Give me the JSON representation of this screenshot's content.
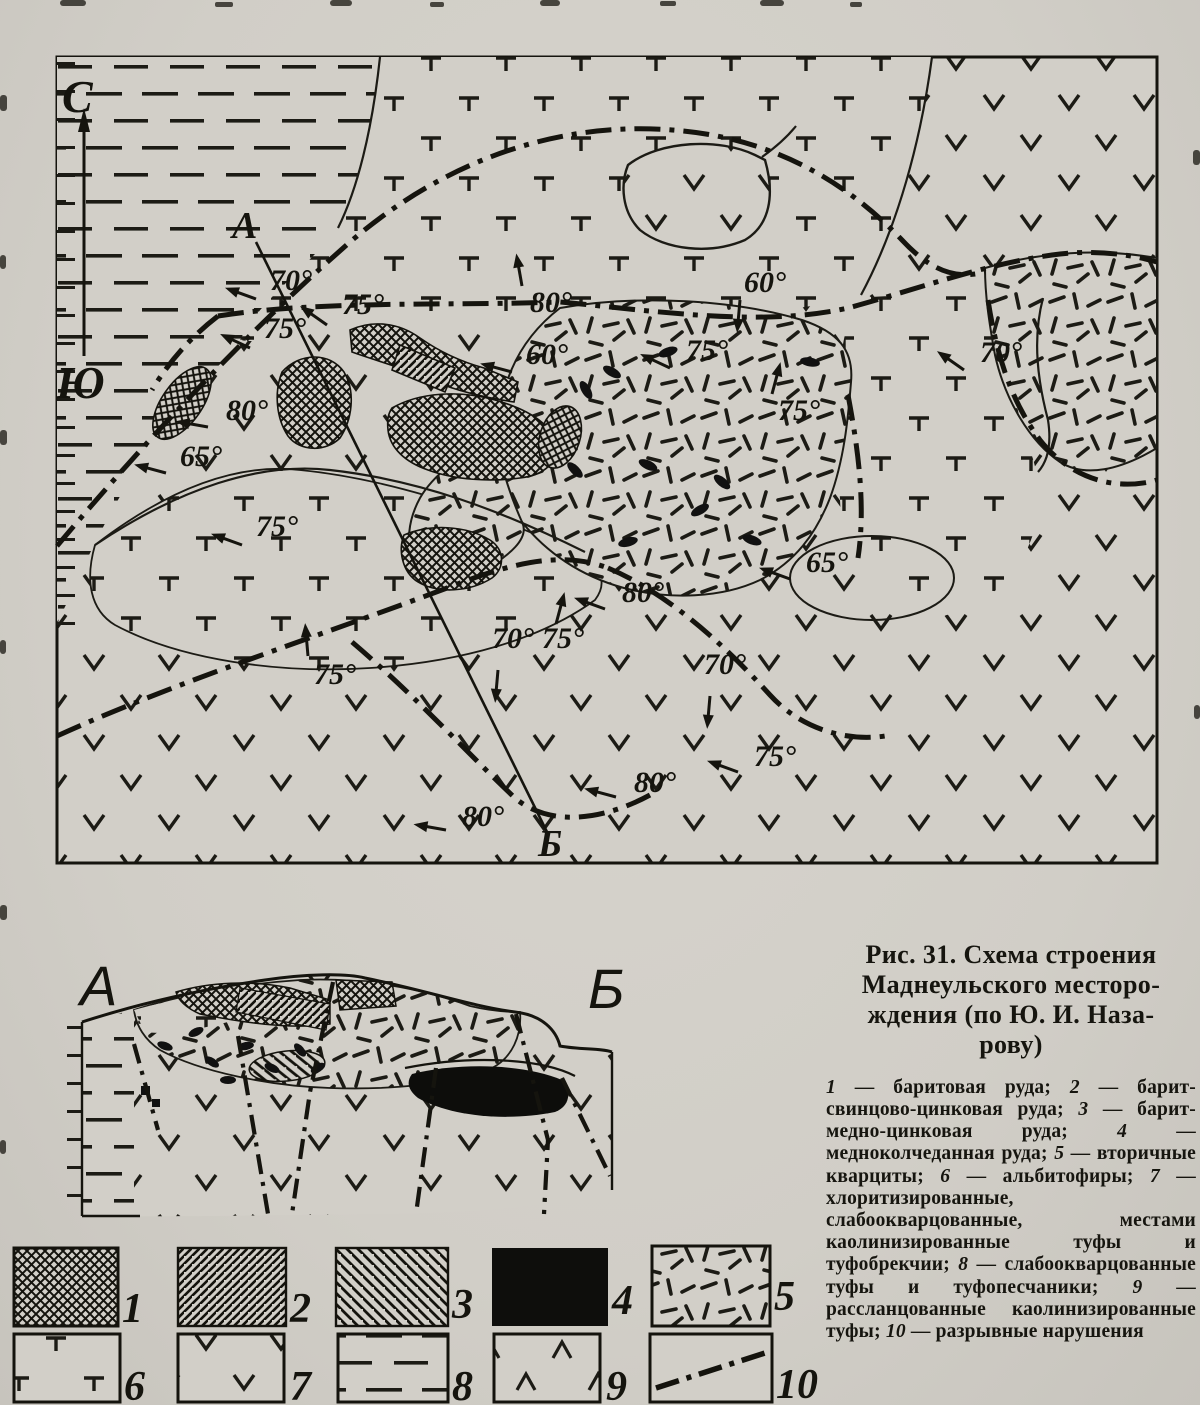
{
  "caption": {
    "title": "Рис. 31. Схема строения\nМаднеульского месторо-\nждения (по Ю. И. Наза-\nрову)",
    "legend_items": [
      {
        "num": "1",
        "label": "баритовая руда"
      },
      {
        "num": "2",
        "label": "барит-свинцово-цинковая руда"
      },
      {
        "num": "3",
        "label": "барит-медно-цинковая руда"
      },
      {
        "num": "4",
        "label": "медноколчеданная руда"
      },
      {
        "num": "5",
        "label": "вторичные кварциты"
      },
      {
        "num": "6",
        "label": "альбитофиры"
      },
      {
        "num": "7",
        "label": "хлоритизированные, слабоокварцованные, местами каолинизированные туфы и туфобрекчии"
      },
      {
        "num": "8",
        "label": "слабоокварцованные туфы и туфопесчаники"
      },
      {
        "num": "9",
        "label": "рассланцованные каолинизированные туфы"
      },
      {
        "num": "10",
        "label": "разрывные нарушения"
      }
    ]
  },
  "map": {
    "compass": {
      "north": "С",
      "south": "Ю"
    },
    "section_labels": {
      "start": "А",
      "end": "Б"
    },
    "dip_labels": [
      {
        "t": "70°",
        "x": 270,
        "y": 290,
        "ax": 256,
        "ay": 299,
        "a": 200
      },
      {
        "t": "75°",
        "x": 264,
        "y": 338,
        "ax": 250,
        "ay": 348,
        "a": 205
      },
      {
        "t": "75°",
        "x": 342,
        "y": 314,
        "ax": 327,
        "ay": 325,
        "a": 215
      },
      {
        "t": "80°",
        "x": 530,
        "y": 312,
        "ax": 522,
        "ay": 286,
        "a": 260
      },
      {
        "t": "60°",
        "x": 526,
        "y": 364,
        "ax": 512,
        "ay": 372,
        "a": 195
      },
      {
        "t": "60°",
        "x": 744,
        "y": 292,
        "ax": 740,
        "ay": 300,
        "a": 95
      },
      {
        "t": "75°",
        "x": 686,
        "y": 360,
        "ax": 670,
        "ay": 368,
        "a": 205
      },
      {
        "t": "70°",
        "x": 980,
        "y": 362,
        "ax": 964,
        "ay": 370,
        "a": 215
      },
      {
        "t": "80°",
        "x": 226,
        "y": 420,
        "ax": 208,
        "ay": 427,
        "a": 190
      },
      {
        "t": "65°",
        "x": 180,
        "y": 466,
        "ax": 166,
        "ay": 473,
        "a": 195
      },
      {
        "t": "75°",
        "x": 256,
        "y": 536,
        "ax": 242,
        "ay": 545,
        "a": 200
      },
      {
        "t": "75°",
        "x": 778,
        "y": 420,
        "ax": 772,
        "ay": 394,
        "a": 285
      },
      {
        "t": "65°",
        "x": 806,
        "y": 572,
        "ax": 790,
        "ay": 579,
        "a": 200
      },
      {
        "t": "80°",
        "x": 622,
        "y": 602,
        "ax": 605,
        "ay": 609,
        "a": 200
      },
      {
        "t": "75°",
        "x": 314,
        "y": 684,
        "ax": 308,
        "ay": 656,
        "a": 265
      },
      {
        "t": "70°",
        "x": 492,
        "y": 648,
        "ax": 498,
        "ay": 670,
        "a": 95
      },
      {
        "t": "75°",
        "x": 542,
        "y": 648,
        "ax": 556,
        "ay": 624,
        "a": 285
      },
      {
        "t": "80°",
        "x": 462,
        "y": 826,
        "ax": 446,
        "ay": 830,
        "a": 190
      },
      {
        "t": "70°",
        "x": 704,
        "y": 674,
        "ax": 710,
        "ay": 696,
        "a": 95
      },
      {
        "t": "75°",
        "x": 754,
        "y": 766,
        "ax": 738,
        "ay": 772,
        "a": 200
      },
      {
        "t": "80°",
        "x": 634,
        "y": 792,
        "ax": 616,
        "ay": 797,
        "a": 195
      }
    ],
    "ore_lenses": [
      {
        "x": 612,
        "y": 372,
        "a": 30
      },
      {
        "x": 668,
        "y": 352,
        "a": -20
      },
      {
        "x": 648,
        "y": 465,
        "a": 25
      },
      {
        "x": 722,
        "y": 482,
        "a": 40
      },
      {
        "x": 700,
        "y": 510,
        "a": -30
      },
      {
        "x": 752,
        "y": 540,
        "a": 20
      },
      {
        "x": 628,
        "y": 542,
        "a": -15
      },
      {
        "x": 586,
        "y": 390,
        "a": 60
      },
      {
        "x": 810,
        "y": 362,
        "a": 10
      },
      {
        "x": 575,
        "y": 470,
        "a": 45
      }
    ]
  },
  "section": {
    "labels": {
      "start": "А",
      "end": "Б"
    },
    "ore_lenses": [
      {
        "x": 165,
        "y": 1046,
        "a": 20
      },
      {
        "x": 196,
        "y": 1032,
        "a": -25
      },
      {
        "x": 212,
        "y": 1062,
        "a": 35
      },
      {
        "x": 246,
        "y": 1046,
        "a": -10
      },
      {
        "x": 272,
        "y": 1068,
        "a": 25
      },
      {
        "x": 300,
        "y": 1050,
        "a": 50
      },
      {
        "x": 228,
        "y": 1080,
        "a": 0
      },
      {
        "x": 318,
        "y": 1068,
        "a": -30
      }
    ]
  }
}
